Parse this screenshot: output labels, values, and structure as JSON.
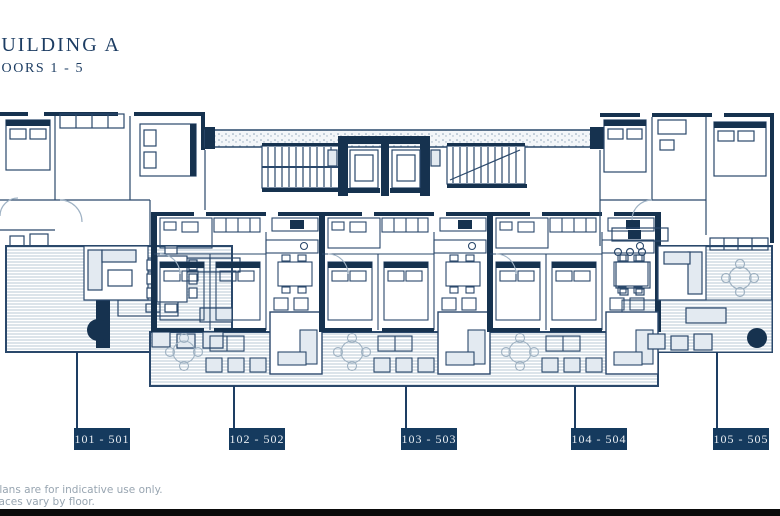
{
  "title": {
    "building": "BUILDING A",
    "floors": "FLOORS 1 - 5"
  },
  "units": [
    {
      "label": "101 - 501"
    },
    {
      "label": "102 - 502"
    },
    {
      "label": "103 - 503"
    },
    {
      "label": "104 - 504"
    },
    {
      "label": "105 - 505"
    }
  ],
  "footer": {
    "disclaimer_line1": "Plans are for indicative use only.",
    "disclaimer_line2": "Terraces vary by floor."
  },
  "colors": {
    "plan_line": "#2a486b",
    "wall_fill": "#16324f",
    "label_box_bg": "#153a5e",
    "label_text": "#e9eef3",
    "title_text": "#1d3d63",
    "deck_stripe": "#b9c8d6",
    "disclaimer_text": "#98a5b1",
    "bottom_bar": "#0b0b0b"
  }
}
